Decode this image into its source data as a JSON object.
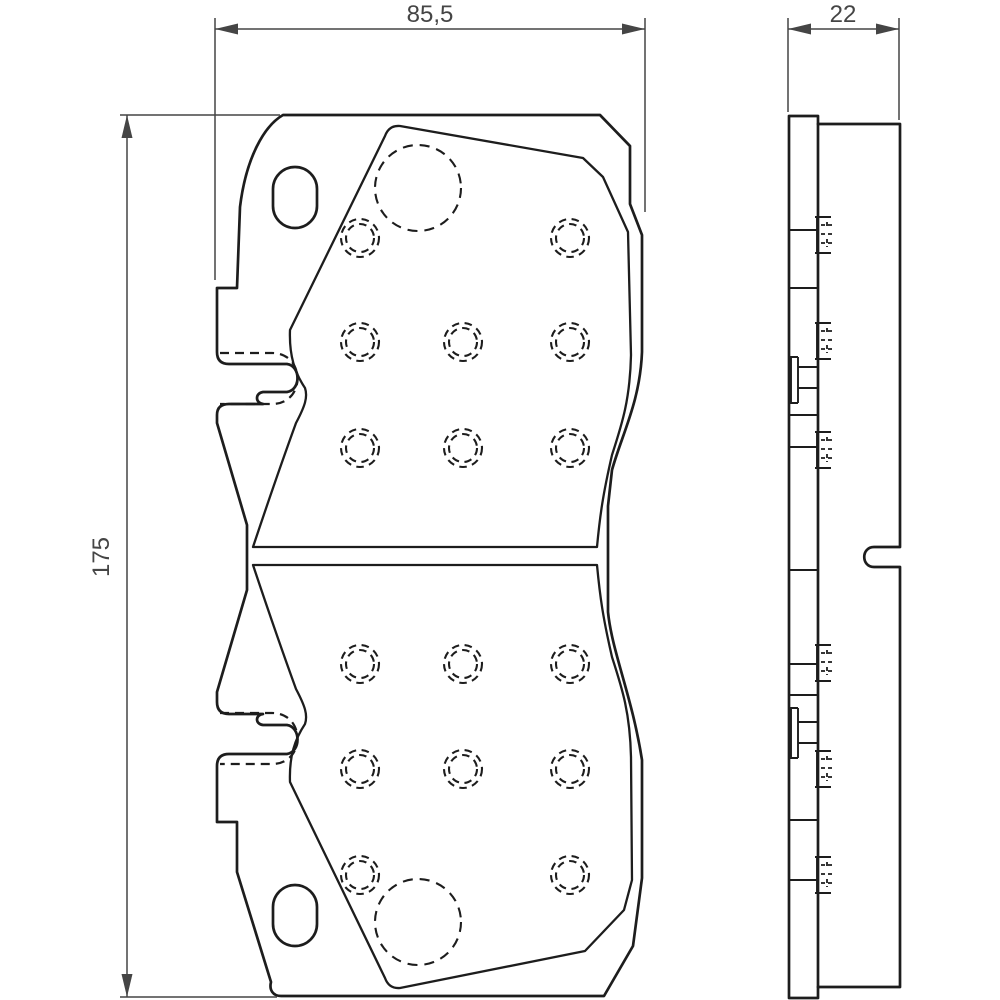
{
  "drawing": {
    "dimensions": {
      "front_width_mm": "85,5",
      "front_height_mm": "175",
      "side_thickness_mm": "22"
    },
    "colors": {
      "background": "#ffffff",
      "outline": "#1d1d1d",
      "dimension": "#454545"
    }
  }
}
